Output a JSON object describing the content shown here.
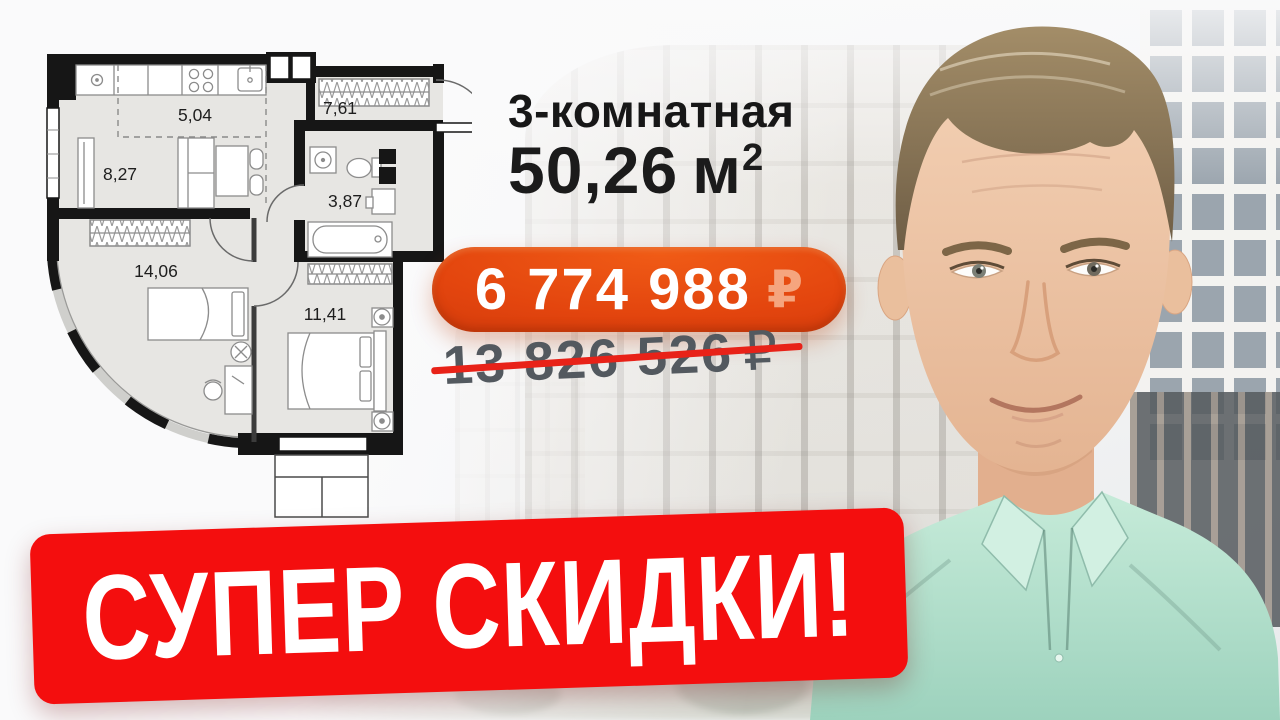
{
  "header": {
    "rooms_label": "3-комнатная",
    "area_value": "50,26",
    "area_unit": "м",
    "area_exponent": "2"
  },
  "pricing": {
    "new_price": "6 774 988",
    "new_price_currency": "₽",
    "old_price": "13 826 526",
    "old_price_currency": "₽"
  },
  "banner": {
    "text": "СУПЕР СКИДКИ!"
  },
  "floor_plan": {
    "rooms": [
      {
        "id": "kitchen-zone",
        "area": "5,04"
      },
      {
        "id": "hallway",
        "area": "7,61"
      },
      {
        "id": "living-zone",
        "area": "8,27"
      },
      {
        "id": "bathroom",
        "area": "3,87"
      },
      {
        "id": "bedroom-large",
        "area": "14,06"
      },
      {
        "id": "bedroom-small",
        "area": "11,41"
      }
    ]
  },
  "colors": {
    "banner_red": "#f40e0e",
    "price_badge_orange": "#e3450e",
    "old_price_gray": "#53595f",
    "headline_black": "#1b1b1b",
    "shirt_mint": "#b7e3d1",
    "plan_wall": "#161616",
    "plan_floor": "#e7e6e3"
  }
}
